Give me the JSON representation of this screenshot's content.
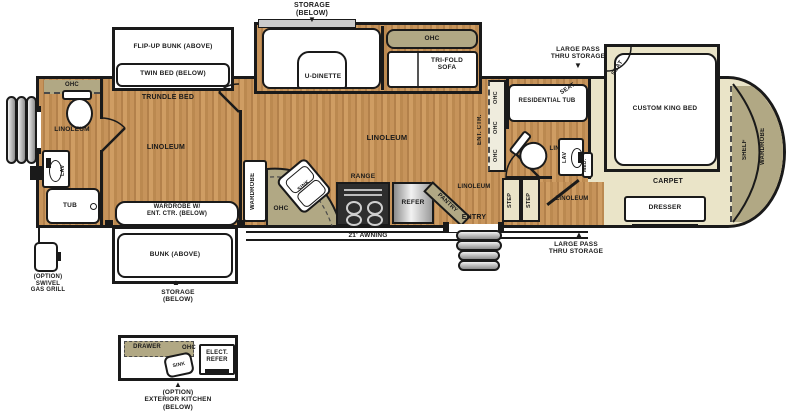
{
  "colors": {
    "wall": "#1a1a1a",
    "wood": "#c6935a",
    "tan": "#eae4c8",
    "khaki": "#b1a884",
    "white": "#ffffff"
  },
  "arrows": {
    "down": "▼",
    "up": "▲"
  },
  "labels": {
    "storage_top": "STORAGE\n(BELOW)",
    "flip_up_bunk": "FLIP-UP BUNK (ABOVE)",
    "twin_bed": "TWIN BED (BELOW)",
    "trundle_bed": "TRUNDLE BED",
    "u_dinette": "U-DINETTE",
    "ohc": "OHC",
    "tri_fold_sofa": "TRI-FOLD\nSOFA",
    "pass_thru": "LARGE PASS\nTHRU STORAGE",
    "seat": "SEAT",
    "custom_king_bed": "CUSTOM KING BED",
    "entry": "ENTRY",
    "linoleum": "LINOLEUM",
    "lav": "LAV",
    "tub": "TUB",
    "wardrobe_ent_ctr": "WARDROBE W/\nENT. CTR. (BELOW)",
    "wardrobe": "WARDROBE",
    "bunk_above": "BUNK (ABOVE)",
    "storage_bottom": "STORAGE\n(BELOW)",
    "option_grill": "(OPTION)\nSWIVEL\nGAS GRILL",
    "sink": "SINK",
    "range": "RANGE",
    "refer": "REFER",
    "pantry": "PANTRY",
    "awning": "21' AWNING",
    "ent_ctr": "ENT. CTR.",
    "residential_tub": "RESIDENTIAL TUB",
    "lino": "LINO.",
    "med": "MED.",
    "step": "STEP",
    "carpet": "CARPET",
    "dresser": "DRESSER",
    "shelf": "SHELF",
    "drawer": "DRAWER",
    "elect_refer": "ELECT.\nREFER",
    "option_ext_kitchen": "(OPTION)\nEXTERIOR KITCHEN\n(BELOW)"
  }
}
